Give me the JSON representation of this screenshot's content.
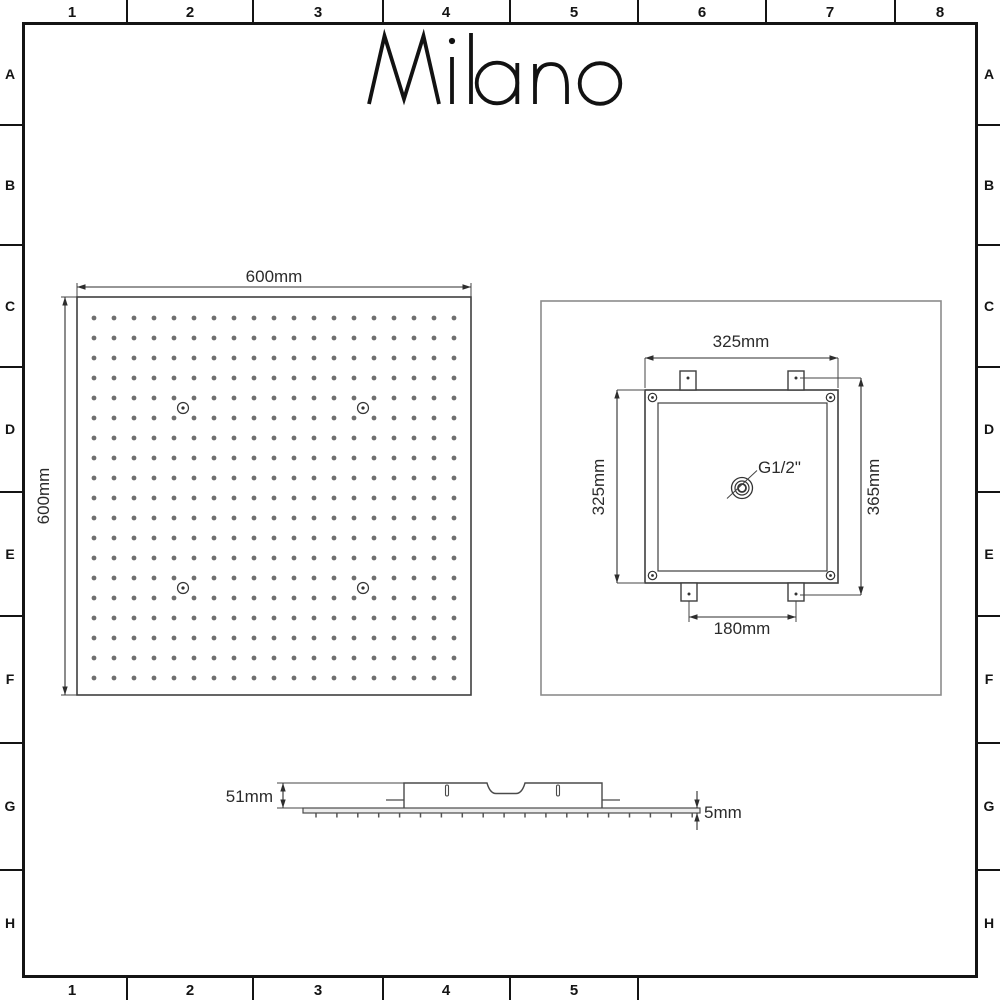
{
  "brand": {
    "name": "Milano"
  },
  "frame": {
    "top_labels": [
      "1",
      "2",
      "3",
      "4",
      "5",
      "6",
      "7",
      "8"
    ],
    "bottom_labels": [
      "1",
      "2",
      "3",
      "4",
      "5"
    ],
    "left_labels": [
      "A",
      "B",
      "C",
      "D",
      "E",
      "F",
      "G",
      "H"
    ],
    "right_labels": [
      "A",
      "B",
      "C",
      "D",
      "E",
      "F",
      "G",
      "H"
    ]
  },
  "front_view": {
    "width_label": "600mm",
    "height_label": "600mm",
    "nozzle_grid": {
      "rows": 19,
      "cols": 19
    },
    "mount_marker_count": 4
  },
  "rear_view": {
    "width_label": "325mm",
    "height_label": "325mm",
    "overall_height_label": "365mm",
    "bracket_spacing_label": "180mm",
    "connection_label": "G1/2\""
  },
  "side_view": {
    "depth_label": "51mm",
    "plate_thickness_label": "5mm"
  },
  "colors": {
    "frame": "#141414",
    "drawing_line": "#3f3f3f",
    "dimension_line": "#2e2e2e",
    "nozzle_dot": "#6f6f6f",
    "light_outline": "#8c8c8c",
    "background": "#ffffff"
  }
}
